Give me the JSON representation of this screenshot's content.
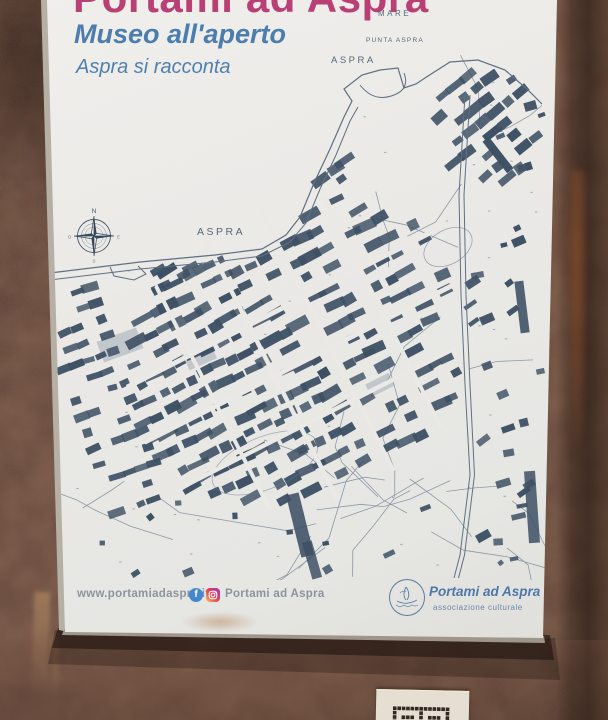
{
  "poster": {
    "title": "Portami ad Aspra",
    "subtitle": "Museo all'aperto",
    "tagline": "Aspra si racconta",
    "map": {
      "label_sea": "MARE",
      "label_punta": "PUNTA ASPRA",
      "label_aspra_upper": "ASPRA",
      "label_aspra_coast": "ASPRA",
      "compass": {
        "north": "N",
        "east": "E",
        "south": "S",
        "west": "O"
      }
    },
    "footer": {
      "website": "www.portamiadaspra.it",
      "social_text": "Portami ad Aspra"
    },
    "logo": {
      "text": "Portami ad Aspra",
      "subtext": "associazione culturale"
    }
  },
  "icons": {
    "facebook": "facebook-icon",
    "facebook_glyph": "f",
    "instagram": "instagram-icon",
    "compass": "compass-rose-icon",
    "logo_emblem": "logo-emblem-icon",
    "qr": "qr-code-icon"
  },
  "colors": {
    "title_pink": "#b93e74",
    "subtitle_blue": "#4a7cae",
    "map_ink": "#3c4f63",
    "map_line": "#66788c",
    "poster_white": "#ebeae6",
    "footer_gray": "#8d939d",
    "facebook_blue": "#4286d3",
    "instagram_pink": "#d6356f",
    "logo_blue": "#4d77a9",
    "wall_brown": "#5f4236",
    "wall_dark": "#3f2a21"
  }
}
